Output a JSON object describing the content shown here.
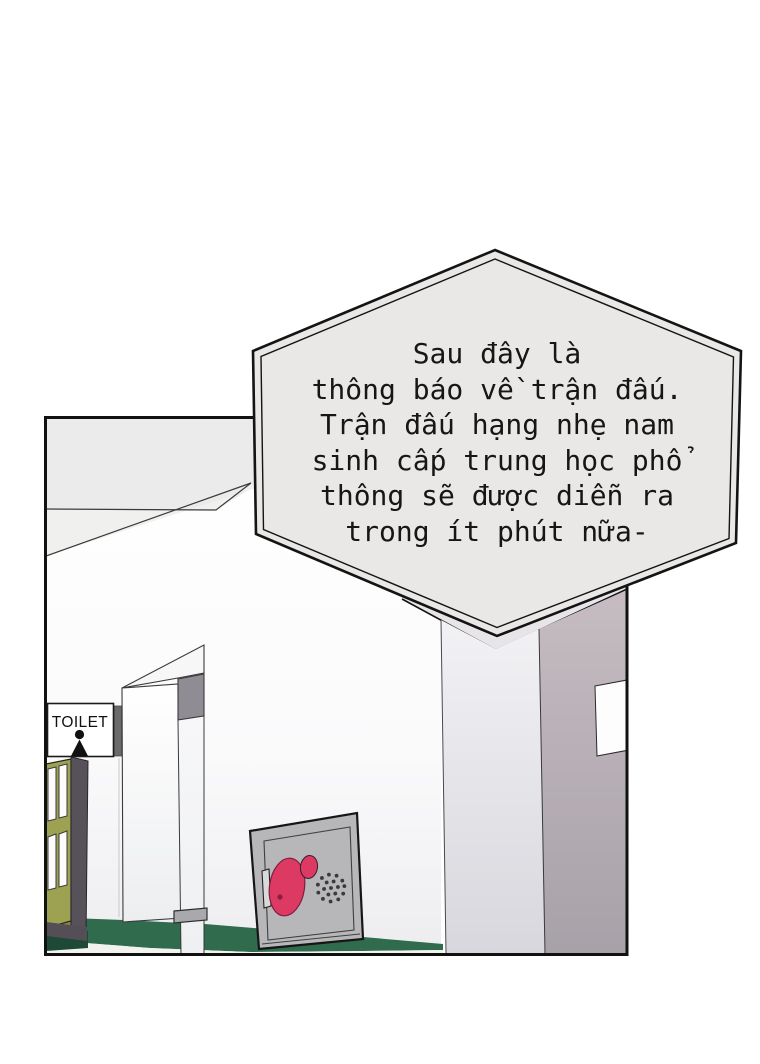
{
  "page": {
    "background": "#ffffff"
  },
  "panel": {
    "border_color": "#111111"
  },
  "bubble": {
    "shape": "hexagon",
    "fill": "#e9e8e6",
    "border_color": "#141414",
    "lines": [
      "Sau đây là",
      "thông báo về trận đấu.",
      "Trận đấu hạng nhẹ nam",
      "sinh cấp trung học phổ",
      "thông sẽ được diễn ra",
      "trong ít phút nữa-"
    ]
  },
  "toilet_sign": {
    "label": "TOILET",
    "icon": "person-icon",
    "tab_color": "#6a6a6c"
  },
  "colors": {
    "ceiling_gray": "#ebebeb",
    "ceiling_wedge": "#f0f0ee",
    "wainscot_green": "#2f6b4c",
    "wainscot_green_dark": "#1d4936",
    "door_olive": "#9ca251",
    "door_olive_dark": "#848a41",
    "door_frame_dark": "#57515a",
    "partition_cap_gray": "#8f8c93",
    "pillar_mauve_top": "#c6bcc2",
    "pillar_mauve_bottom": "#a7a1a8",
    "cabinet_gray": "#b7b7b9",
    "accent_pink": "#dc3a63",
    "floor_light": "#f2f2ef"
  }
}
